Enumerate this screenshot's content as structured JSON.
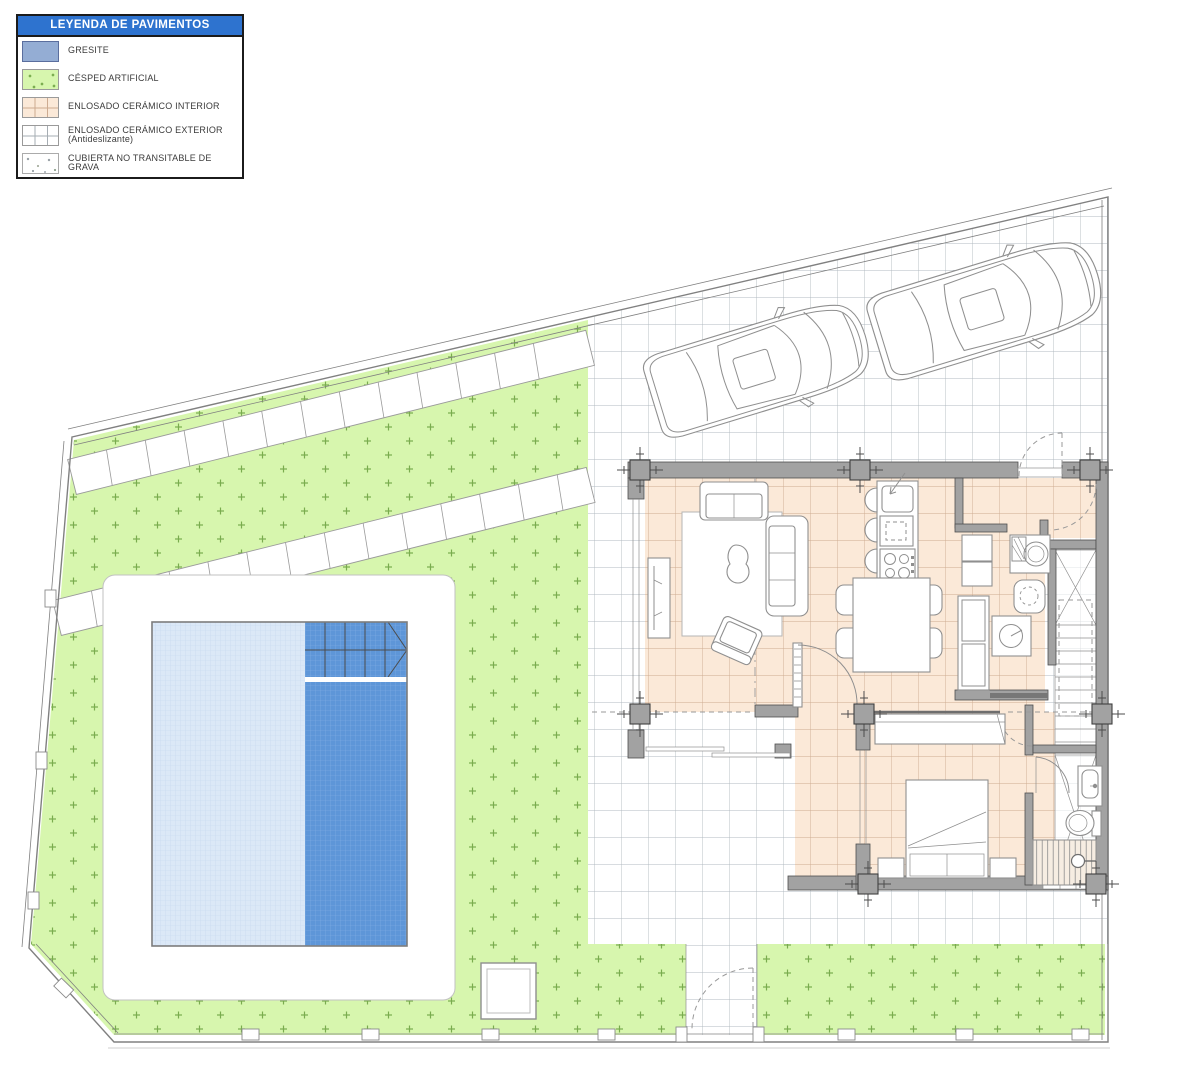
{
  "legend": {
    "title": "LEYENDA DE PAVIMENTOS",
    "items": [
      {
        "id": "gresite",
        "label": "GRESITE"
      },
      {
        "id": "cesped-artificial",
        "label": "CÉSPED ARTIFICIAL"
      },
      {
        "id": "enlosado-ceramico-interior",
        "label": "ENLOSADO CERÁMICO INTERIOR"
      },
      {
        "id": "enlosado-ceramico-exterior",
        "label": "ENLOSADO CERÁMICO EXTERIOR (Antideslizante)"
      },
      {
        "id": "cubierta-grava",
        "label": "CUBIERTA NO TRANSITABLE DE GRAVA"
      }
    ]
  },
  "colors": {
    "legend_header_bg": "#2e73cf",
    "legend_header_text": "#ffffff",
    "gresite": "#94add4",
    "grass_fill": "#d7f6ae",
    "grass_dot": "#79ac4e",
    "ext_line": "#b1b9c0",
    "int_fill": "#fbe9d8",
    "int_line": "#cdab91",
    "pool_light": "#dbe8f7",
    "pool_light_line": "#c3d7ef",
    "pool_dark": "#5e96d8",
    "pool_dark_line": "#83b0e4",
    "wall_fill": "#a2a2a2",
    "wall_edge": "#4f4f4f",
    "line_gray": "#8f8f8f",
    "dash_gray": "#999999",
    "boundary": "#808080"
  }
}
